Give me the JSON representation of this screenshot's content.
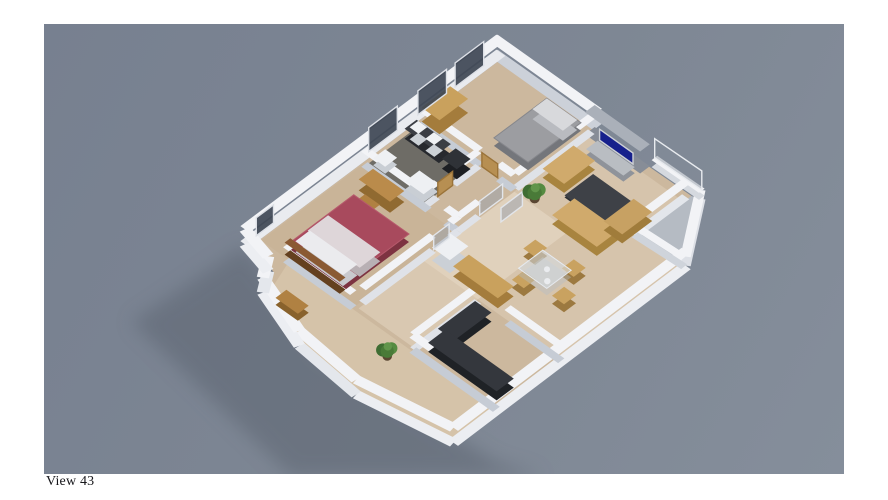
{
  "viewer": {
    "caption": "View 43"
  },
  "canvas": {
    "bg_from": "#778090",
    "bg_to": "#858e9b"
  },
  "colors": {
    "background_gray": "#7e8794",
    "wall_top": "#f2f3f6",
    "wall_face_bright": "#eceef2",
    "wall_face_shaded": "#c6ccd5",
    "floor_beige": "#ccb89e",
    "bathroom_floor": "#6e6c66",
    "wood_furniture": "#c9a15d",
    "sofa_tan": "#d0aa6c",
    "bed_red": "#a84a5d",
    "bed_gray": "#9c9da1",
    "tv_screen": "#16208c",
    "counter_dark": "#34373d",
    "plant_green": "#4e7a3c",
    "window_glass": "#3e4654",
    "shadow": "#5a626e"
  },
  "scene": {
    "m": [
      29.8,
      21.2,
      -28.6,
      21.4,
      453,
      26
    ],
    "shadow": {
      "pts": [
        [
          200,
          222
        ],
        [
          88,
          298
        ],
        [
          247,
          452
        ],
        [
          500,
          452
        ],
        [
          452,
          438
        ],
        [
          280,
          328
        ]
      ],
      "fill": "#5a626e",
      "opacity": 0.5
    },
    "floors": [
      {
        "name": "main-floor",
        "pts": [
          [
            0.28,
            0.28
          ],
          [
            6.88,
            0.18
          ],
          [
            8.16,
            2.0
          ],
          [
            8.2,
            10.1
          ],
          [
            5.5,
            10.58
          ],
          [
            3.45,
            10.38
          ],
          [
            1.62,
            9.72
          ],
          [
            1.25,
            9.12
          ],
          [
            0.28,
            8.82
          ]
        ],
        "fill": "#ccb89e"
      },
      {
        "name": "balcony-floor",
        "pts": [
          [
            6.7,
            0.18
          ],
          [
            6.88,
            0.14
          ],
          [
            8.12,
            1.95
          ],
          [
            6.7,
            2.02
          ]
        ],
        "fill": "#b5bbc3"
      },
      {
        "name": "living-tint",
        "pts": [
          [
            3.55,
            0.45
          ],
          [
            6.6,
            0.45
          ],
          [
            6.6,
            2.1
          ],
          [
            8.1,
            2.05
          ],
          [
            8.15,
            6.3
          ],
          [
            3.55,
            6.3
          ]
        ],
        "fill": "rgba(255,246,228,0.20)"
      },
      {
        "name": "hall-tint",
        "pts": [
          [
            3.56,
            3.1
          ],
          [
            5.4,
            3.1
          ],
          [
            5.4,
            8.55
          ],
          [
            3.56,
            8.55
          ]
        ],
        "fill": "rgba(255,248,235,0.25)"
      },
      {
        "name": "master-tint",
        "pts": [
          [
            0.32,
            5.05
          ],
          [
            3.45,
            5.05
          ],
          [
            3.45,
            8.58
          ],
          [
            0.32,
            8.58
          ]
        ],
        "fill": "rgba(190,160,120,0.15)"
      },
      {
        "name": "wing-tint",
        "pts": [
          [
            1.3,
            8.66
          ],
          [
            8.2,
            8.66
          ],
          [
            8.2,
            10.05
          ],
          [
            5.5,
            10.55
          ],
          [
            3.47,
            10.35
          ],
          [
            1.65,
            9.68
          ]
        ],
        "fill": "rgba(230,214,188,0.35)"
      },
      {
        "name": "bathroom-floor",
        "pts": [
          [
            0.4,
            3.45
          ],
          [
            2.28,
            3.45
          ],
          [
            2.28,
            4.92
          ],
          [
            0.4,
            4.92
          ]
        ],
        "fill": "#6e6c66"
      }
    ],
    "walls": [
      {
        "a": [
          0,
          0.13
        ],
        "b": [
          3.5,
          0.13
        ],
        "t": 0.3,
        "h": 15,
        "side": "#ccd1d9"
      },
      {
        "a": [
          0.13,
          0
        ],
        "b": [
          0.13,
          8.95
        ],
        "t": 0.3,
        "h": 15,
        "side": "#e9ebef"
      },
      {
        "a": [
          8.22,
          1.95
        ],
        "b": [
          8.28,
          10.15
        ],
        "t": 0.3,
        "h": 15,
        "side": "#eceef2"
      },
      {
        "a": [
          8.28,
          10.15
        ],
        "b": [
          5.5,
          10.65
        ],
        "t": 0.3,
        "h": 15,
        "side": "#eceef2"
      },
      {
        "a": [
          5.5,
          10.65
        ],
        "b": [
          3.4,
          10.45
        ],
        "t": 0.3,
        "h": 15,
        "side": "#e4e7ec"
      },
      {
        "a": [
          3.4,
          10.45
        ],
        "b": [
          1.55,
          9.8
        ],
        "t": 0.3,
        "h": 15,
        "side": "#eceef2"
      },
      {
        "a": [
          1.55,
          9.8
        ],
        "b": [
          1.15,
          9.2
        ],
        "t": 0.3,
        "h": 15,
        "side": "#e4e7ec"
      },
      {
        "a": [
          1.15,
          9.2
        ],
        "b": [
          0.13,
          8.95
        ],
        "t": 0.3,
        "h": 15,
        "side": "#eceef2"
      },
      {
        "a": [
          6.92,
          0.1
        ],
        "b": [
          8.2,
          1.95
        ],
        "t": 0.25,
        "h": 9,
        "side": "#dde0e6"
      },
      {
        "a": [
          5.35,
          0.07
        ],
        "b": [
          6.92,
          0.05
        ],
        "t": 0.2,
        "h": 7,
        "side": "#d5d9df"
      },
      {
        "a": [
          3.45,
          0.35
        ],
        "b": [
          5.3,
          0.35
        ],
        "t": 0.34,
        "h": 22,
        "top": "#aab0b9",
        "side": "#878d97"
      },
      {
        "a": [
          6.62,
          0.3
        ],
        "b": [
          6.62,
          2.1
        ],
        "t": 0.24,
        "h": 15,
        "side": "#e3e6eb"
      },
      {
        "a": [
          6.62,
          2.08
        ],
        "b": [
          8.2,
          2.0
        ],
        "t": 0.22,
        "h": 9,
        "side": "#cfd4db"
      },
      {
        "a": [
          3.5,
          0.35
        ],
        "b": [
          3.5,
          3.0
        ],
        "t": 0.22,
        "h": 15,
        "side": "#dfe2e8"
      },
      {
        "a": [
          0.35,
          3.05
        ],
        "b": [
          2.35,
          3.05
        ],
        "t": 0.22,
        "h": 15,
        "side": "#c6ccd5"
      },
      {
        "a": [
          3.0,
          3.05
        ],
        "b": [
          3.5,
          3.05
        ],
        "t": 0.22,
        "h": 15,
        "side": "#c6ccd5"
      },
      {
        "a": [
          2.35,
          3.1
        ],
        "b": [
          2.35,
          3.95
        ],
        "t": 0.2,
        "h": 15,
        "side": "#dfe2e8"
      },
      {
        "a": [
          2.35,
          4.55
        ],
        "b": [
          2.35,
          5.0
        ],
        "t": 0.2,
        "h": 15,
        "side": "#dfe2e8"
      },
      {
        "a": [
          0.35,
          5.0
        ],
        "b": [
          2.5,
          5.0
        ],
        "t": 0.22,
        "h": 15,
        "side": "#c6ccd5"
      },
      {
        "a": [
          3.1,
          5.0
        ],
        "b": [
          3.5,
          5.0
        ],
        "t": 0.22,
        "h": 15,
        "side": "#c6ccd5"
      },
      {
        "a": [
          3.5,
          4.3
        ],
        "b": [
          3.5,
          5.0
        ],
        "t": 0.2,
        "h": 15,
        "side": "#dfe2e8"
      },
      {
        "a": [
          3.5,
          5.9
        ],
        "b": [
          3.5,
          8.35
        ],
        "t": 0.22,
        "h": 15,
        "side": "#dfe2e8"
      },
      {
        "a": [
          3.5,
          5.0
        ],
        "b": [
          3.5,
          5.28
        ],
        "t": 0.22,
        "h": 15,
        "side": "#dfe2e8"
      },
      {
        "a": [
          5.45,
          6.35
        ],
        "b": [
          5.45,
          8.6
        ],
        "t": 0.22,
        "h": 15,
        "side": "#dfe2e8"
      },
      {
        "a": [
          6.45,
          6.35
        ],
        "b": [
          8.25,
          6.35
        ],
        "t": 0.22,
        "h": 15,
        "side": "#c6ccd5"
      },
      {
        "a": [
          5.45,
          8.62
        ],
        "b": [
          8.25,
          8.62
        ],
        "t": 0.24,
        "h": 15,
        "side": "#c6ccd5"
      },
      {
        "a": [
          1.2,
          8.62
        ],
        "b": [
          3.45,
          8.62
        ],
        "t": 0.22,
        "h": 15,
        "side": "#c6ccd5"
      }
    ],
    "boxes": [
      {
        "name": "bed-gray",
        "r": [
          2.15,
          0.5,
          1.15,
          1.85
        ],
        "h": 8,
        "top": "#9c9da1",
        "side": "#74767b",
        "stroke": "#86878c"
      },
      {
        "name": "bed-gray-pillow",
        "r": [
          2.2,
          0.55,
          1.02,
          0.5
        ],
        "h": 10,
        "top": "#d8d9dc",
        "side": "#b9bbc0"
      },
      {
        "name": "wardrobe",
        "r": [
          0.35,
          2.0,
          0.6,
          1.0
        ],
        "h": 14,
        "top": "#c9a15d",
        "side": "#a47c3c"
      },
      {
        "name": "tv-stand",
        "r": [
          3.95,
          0.6,
          1.25,
          0.4
        ],
        "h": 6,
        "top": "#b9bdc2",
        "side": "#8f939a"
      },
      {
        "name": "loveseat",
        "r": [
          3.72,
          1.2,
          0.72,
          1.08
        ],
        "h": 9,
        "top": "#d0aa6c",
        "side": "#a8843f"
      },
      {
        "name": "rug-dark",
        "r": [
          4.55,
          1.38,
          1.4,
          1.0
        ],
        "h": 2,
        "top": "#3e4147",
        "side": "#2e3136"
      },
      {
        "name": "sofa",
        "r": [
          4.95,
          2.45,
          1.5,
          0.78
        ],
        "h": 9,
        "top": "#d0aa6c",
        "side": "#a8843f"
      },
      {
        "name": "chaise",
        "r": [
          5.98,
          1.45,
          0.62,
          1.05
        ],
        "h": 9,
        "top": "#c7a163",
        "side": "#a07c3b"
      },
      {
        "name": "dining-chair",
        "r": [
          5.2,
          4.08,
          0.4,
          0.42
        ],
        "h": 8,
        "top": "#c9a260",
        "side": "#9c7940"
      },
      {
        "name": "dining-chair",
        "r": [
          6.32,
          3.9,
          0.4,
          0.42
        ],
        "h": 8,
        "top": "#c9a260",
        "side": "#9c7940"
      },
      {
        "name": "dining-chair",
        "r": [
          5.72,
          5.02,
          0.4,
          0.42
        ],
        "h": 8,
        "top": "#c9a260",
        "side": "#9c7940"
      },
      {
        "name": "dining-chair",
        "r": [
          6.78,
          4.72,
          0.4,
          0.42
        ],
        "h": 8,
        "top": "#c9a260",
        "side": "#9c7940"
      },
      {
        "name": "dining-table",
        "r": [
          5.55,
          4.18,
          0.95,
          0.85
        ],
        "h": 7,
        "top": "rgba(214,223,231,0.55)",
        "side": "rgba(180,190,200,0.4)",
        "stroke": "#e6eaef"
      },
      {
        "name": "fridge",
        "r": [
          3.72,
          5.5,
          0.6,
          0.65
        ],
        "h": 13,
        "top": "#eef0f3",
        "side": "#cbd0d6"
      },
      {
        "name": "sideboard",
        "r": [
          4.45,
          5.62,
          1.5,
          0.55
        ],
        "h": 10,
        "top": "#c9a15d",
        "side": "#a47c3c"
      },
      {
        "name": "counter-left",
        "r": [
          5.6,
          6.6,
          0.55,
          1.3
        ],
        "h": 9,
        "top": "#34373d",
        "side": "#1f2226"
      },
      {
        "name": "counter-bottom",
        "r": [
          5.75,
          7.8,
          2.3,
          0.6
        ],
        "h": 9,
        "top": "#34373d",
        "side": "#1f2226"
      },
      {
        "name": "desk",
        "r": [
          0.85,
          5.22,
          1.05,
          0.5
        ],
        "h": 11,
        "top": "#ba8b4b",
        "side": "#906a31"
      },
      {
        "name": "wood-chair",
        "r": [
          1.25,
          5.92,
          0.5,
          0.55
        ],
        "h": 9,
        "top": "#b08142",
        "side": "#89622c"
      },
      {
        "name": "office-chair",
        "r": [
          1.98,
          6.35,
          0.48,
          0.48
        ],
        "h": 8,
        "top": "#37393e",
        "side": "#232529"
      },
      {
        "name": "bed-red",
        "r": [
          1.05,
          6.1,
          1.85,
          2.2
        ],
        "h": 8,
        "top": "#a84a5d",
        "side": "#7d3341",
        "stroke": "#b65a6c"
      },
      {
        "name": "bed-red-sheet",
        "r": [
          1.1,
          7.05,
          1.75,
          0.72
        ],
        "h": 9,
        "top": "#ded6d9",
        "side": "#b8b0b4"
      },
      {
        "name": "bed-red-pillows",
        "r": [
          1.18,
          7.78,
          1.6,
          0.5
        ],
        "h": 11,
        "top": "#ebebee",
        "side": "#c9c9ce"
      },
      {
        "name": "headboard",
        "r": [
          1.05,
          8.32,
          1.85,
          0.2
        ],
        "h": 12,
        "top": "#8a5a33",
        "side": "#64401f"
      },
      {
        "name": "bench",
        "r": [
          2.05,
          9.5,
          0.75,
          0.38
        ],
        "h": 7,
        "top": "#b08142",
        "side": "#89622c"
      },
      {
        "name": "vanity",
        "r": [
          0.45,
          3.28,
          1.15,
          0.42
        ],
        "h": 10,
        "top": "#3b3e44",
        "side": "#27292e"
      },
      {
        "name": "sink",
        "r": [
          0.55,
          3.33,
          0.3,
          0.3
        ],
        "h": 12,
        "top": "#f0f2f4",
        "side": "#ccd1d6"
      },
      {
        "name": "sink",
        "r": [
          1.08,
          3.33,
          0.3,
          0.3
        ],
        "h": 12,
        "top": "#f0f2f4",
        "side": "#ccd1d6"
      },
      {
        "name": "washer",
        "r": [
          1.78,
          3.3,
          0.5,
          0.48
        ],
        "h": 10,
        "top": "#2f3237",
        "side": "#1d1f23"
      },
      {
        "name": "tub",
        "r": [
          1.62,
          4.4,
          0.62,
          0.5
        ],
        "h": 8,
        "top": "#eef0f3",
        "side": "#c9ced4"
      },
      {
        "name": "toilet",
        "r": [
          0.52,
          4.45,
          0.4,
          0.42
        ],
        "h": 7,
        "top": "#eef0f3",
        "side": "#c9ced4"
      }
    ],
    "panels": [
      {
        "name": "window",
        "a": [
          0.13,
          0.6
        ],
        "b": [
          0.13,
          1.6
        ],
        "h0": 0,
        "h1": 24,
        "fill": "rgba(62,70,84,0.92)",
        "stroke": "#dde0e6"
      },
      {
        "name": "window",
        "a": [
          0.13,
          1.9
        ],
        "b": [
          0.13,
          2.9
        ],
        "h0": 0,
        "h1": 24,
        "fill": "rgba(62,70,84,0.92)",
        "stroke": "#dde0e6"
      },
      {
        "name": "window",
        "a": [
          0.13,
          3.62
        ],
        "b": [
          0.13,
          4.62
        ],
        "h0": 0,
        "h1": 24,
        "fill": "rgba(62,70,84,0.92)",
        "stroke": "#dde0e6"
      },
      {
        "name": "window",
        "a": [
          0.13,
          7.95
        ],
        "b": [
          0.13,
          8.55
        ],
        "h0": 0,
        "h1": 18,
        "fill": "rgba(62,70,84,0.92)",
        "stroke": "#dde0e6"
      },
      {
        "name": "balcony-glass",
        "a": [
          5.35,
          0.06
        ],
        "b": [
          6.9,
          0.03
        ],
        "h0": 7,
        "h1": 26,
        "fill": "rgba(130,140,152,0.42)",
        "stroke": "#e8ebef"
      },
      {
        "name": "tv-screen",
        "a": [
          4.0,
          0.58
        ],
        "b": [
          5.12,
          0.58
        ],
        "h0": 7,
        "h1": 18,
        "fill": "#16208c",
        "stroke": "#cdd0d5"
      },
      {
        "name": "door-wood",
        "a": [
          2.42,
          3.05
        ],
        "b": [
          2.95,
          3.05
        ],
        "h0": 0,
        "h1": 14,
        "fill": "#b78f52",
        "stroke": "#9a7339"
      },
      {
        "name": "door-wood",
        "a": [
          2.35,
          4.0
        ],
        "b": [
          2.35,
          4.52
        ],
        "h0": 0,
        "h1": 14,
        "fill": "#b78f52",
        "stroke": "#9a7339"
      },
      {
        "name": "door-glass",
        "a": [
          3.5,
          5.32
        ],
        "b": [
          3.5,
          5.86
        ],
        "h0": 0,
        "h1": 14,
        "fill": "rgba(150,158,170,0.5)",
        "stroke": "#e2e5ea"
      },
      {
        "name": "door-glass",
        "a": [
          4.02,
          3.3
        ],
        "b": [
          4.02,
          4.05
        ],
        "h0": 0,
        "h1": 14,
        "fill": "rgba(150,158,170,0.5)",
        "stroke": "#e2e5ea"
      },
      {
        "name": "door-glass",
        "a": [
          3.5,
          3.45
        ],
        "b": [
          3.5,
          4.25
        ],
        "h0": 0,
        "h1": 14,
        "fill": "rgba(150,158,170,0.5)",
        "stroke": "#e2e5ea"
      }
    ],
    "plants": [
      {
        "c": [
          3.95,
          2.8
        ],
        "r": 13
      },
      {
        "c": [
          5.05,
          9.1
        ],
        "r": 12
      }
    ],
    "dots": [
      {
        "c": [
          5.9,
          4.4
        ],
        "r": 3,
        "fill": "#eaecef"
      },
      {
        "c": [
          6.18,
          4.68
        ],
        "r": 3.2,
        "fill": "#eaecef"
      }
    ]
  }
}
